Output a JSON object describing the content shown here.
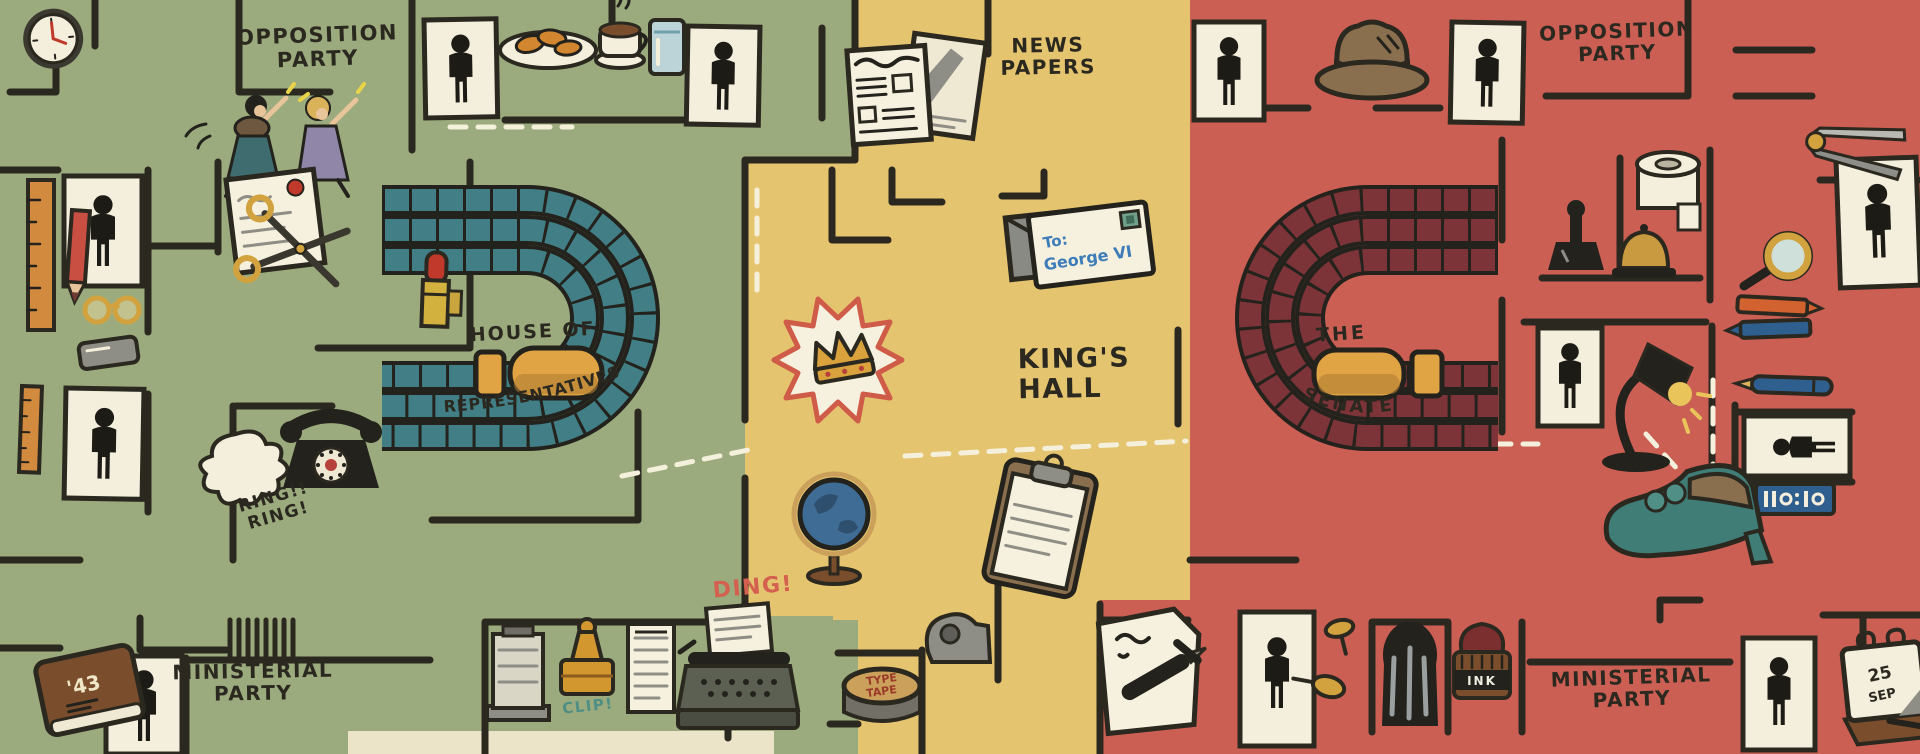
{
  "canvas": {
    "width": 1920,
    "height": 754
  },
  "title": "Hand-drawn parliament floor-plan maze",
  "palette": {
    "green_zone": "#9cab7d",
    "yellow_zone": "#e5c46f",
    "red_zone": "#cc5f54",
    "wall": "#2b2820",
    "card": "#f4efdc",
    "house_seats": "#417e85",
    "senate_seats": "#7c3438",
    "table": "#e0a445",
    "accent_red": "#d4604f",
    "callout_teal": "#4e8f85",
    "route_dash": "#f5f0dc",
    "hand_blue": "#3c7cb8"
  },
  "zones": {
    "left": {
      "name": "House of Representatives side",
      "color": "#9cab7d"
    },
    "center": {
      "name": "King's Hall corridor",
      "color": "#e5c46f"
    },
    "right": {
      "name": "Senate side",
      "color": "#cc5f54"
    }
  },
  "labels": {
    "opposition_left": "OPPOSITION\nPARTY",
    "opposition_right": "OPPOSITION\nPARTY",
    "ministerial_left": "MINISTERIAL\nPARTY",
    "ministerial_right": "MINISTERIAL\nPARTY",
    "news_papers": "NEWS\nPAPERS",
    "kings_hall": "KING'S\nHALL",
    "house_top": "HOUSE OF",
    "house_curved": "REPRESENTATIVES",
    "senate_top": "THE",
    "senate_curved": "SENATE",
    "ring": "RING!!\nRING!",
    "ding": "DING!",
    "clip": "CLIP!",
    "ink": "INK",
    "tin_line1": "TYPE",
    "tin_line2": "TAPE",
    "envelope_line1": "To:",
    "envelope_line2": "George VI",
    "calendar_line1": "25",
    "calendar_line2": "SEP",
    "book_year": "'43"
  },
  "icons": {
    "wall-clock": "analog clock, red hands",
    "running-women": "two running women",
    "person-door-sign": "black figure on white door card",
    "croissants-plate": "plate of croissants",
    "coffee-cup": "steaming coffee cup",
    "water-glass": "glass of water",
    "ruler": "wooden ruler",
    "red-pencil": "red pencil",
    "reading-glasses": "round gold spectacles",
    "signed-paper": "document with red seal",
    "scissors": "gold-handled scissors",
    "lipstick": "open red lipstick",
    "eraser": "grey eraser",
    "rotary-telephone": "black rotary phone",
    "stairs": "staircase hatching",
    "book-1943": "brown diary marked '43",
    "card-file": "grey card index",
    "clip-stamp": "orange paper clamp",
    "memo-sheet": "lined memo sheet",
    "typewriter": "typewriter with paper",
    "newspapers": "folded newspapers",
    "envelope-letter": "letter addressed To: George VI",
    "crown-burst": "gold crown in starburst",
    "globe": "desk globe",
    "clipboard": "clipboard with notes",
    "tape-dispenser": "grey tape dispenser",
    "ribbon-tin": "typewriter ribbon tin TYPE TAPE",
    "fedora-hat": "brown fedora, teal band",
    "drafting-compass": "drafting compass",
    "toilet-roll": "toilet paper roll",
    "date-stamp": "black desk stamp",
    "desk-bell": "brass desk bell",
    "magnifier": "magnifying glass",
    "crayons": "orange and blue crayons",
    "blue-pencil": "blue pencil",
    "division-sign": "blue indicator sign",
    "desk-lamp": "arched desk lamp, lit",
    "heeled-shoe": "teal heeled shoe",
    "letter-and-pen": "letter with fountain pen",
    "push-pins": "brass push pins",
    "ink-well": "dark glass ink well",
    "ink-pot": "ink pot labelled INK",
    "desk-calendar": "flip calendar 25 SEP"
  }
}
